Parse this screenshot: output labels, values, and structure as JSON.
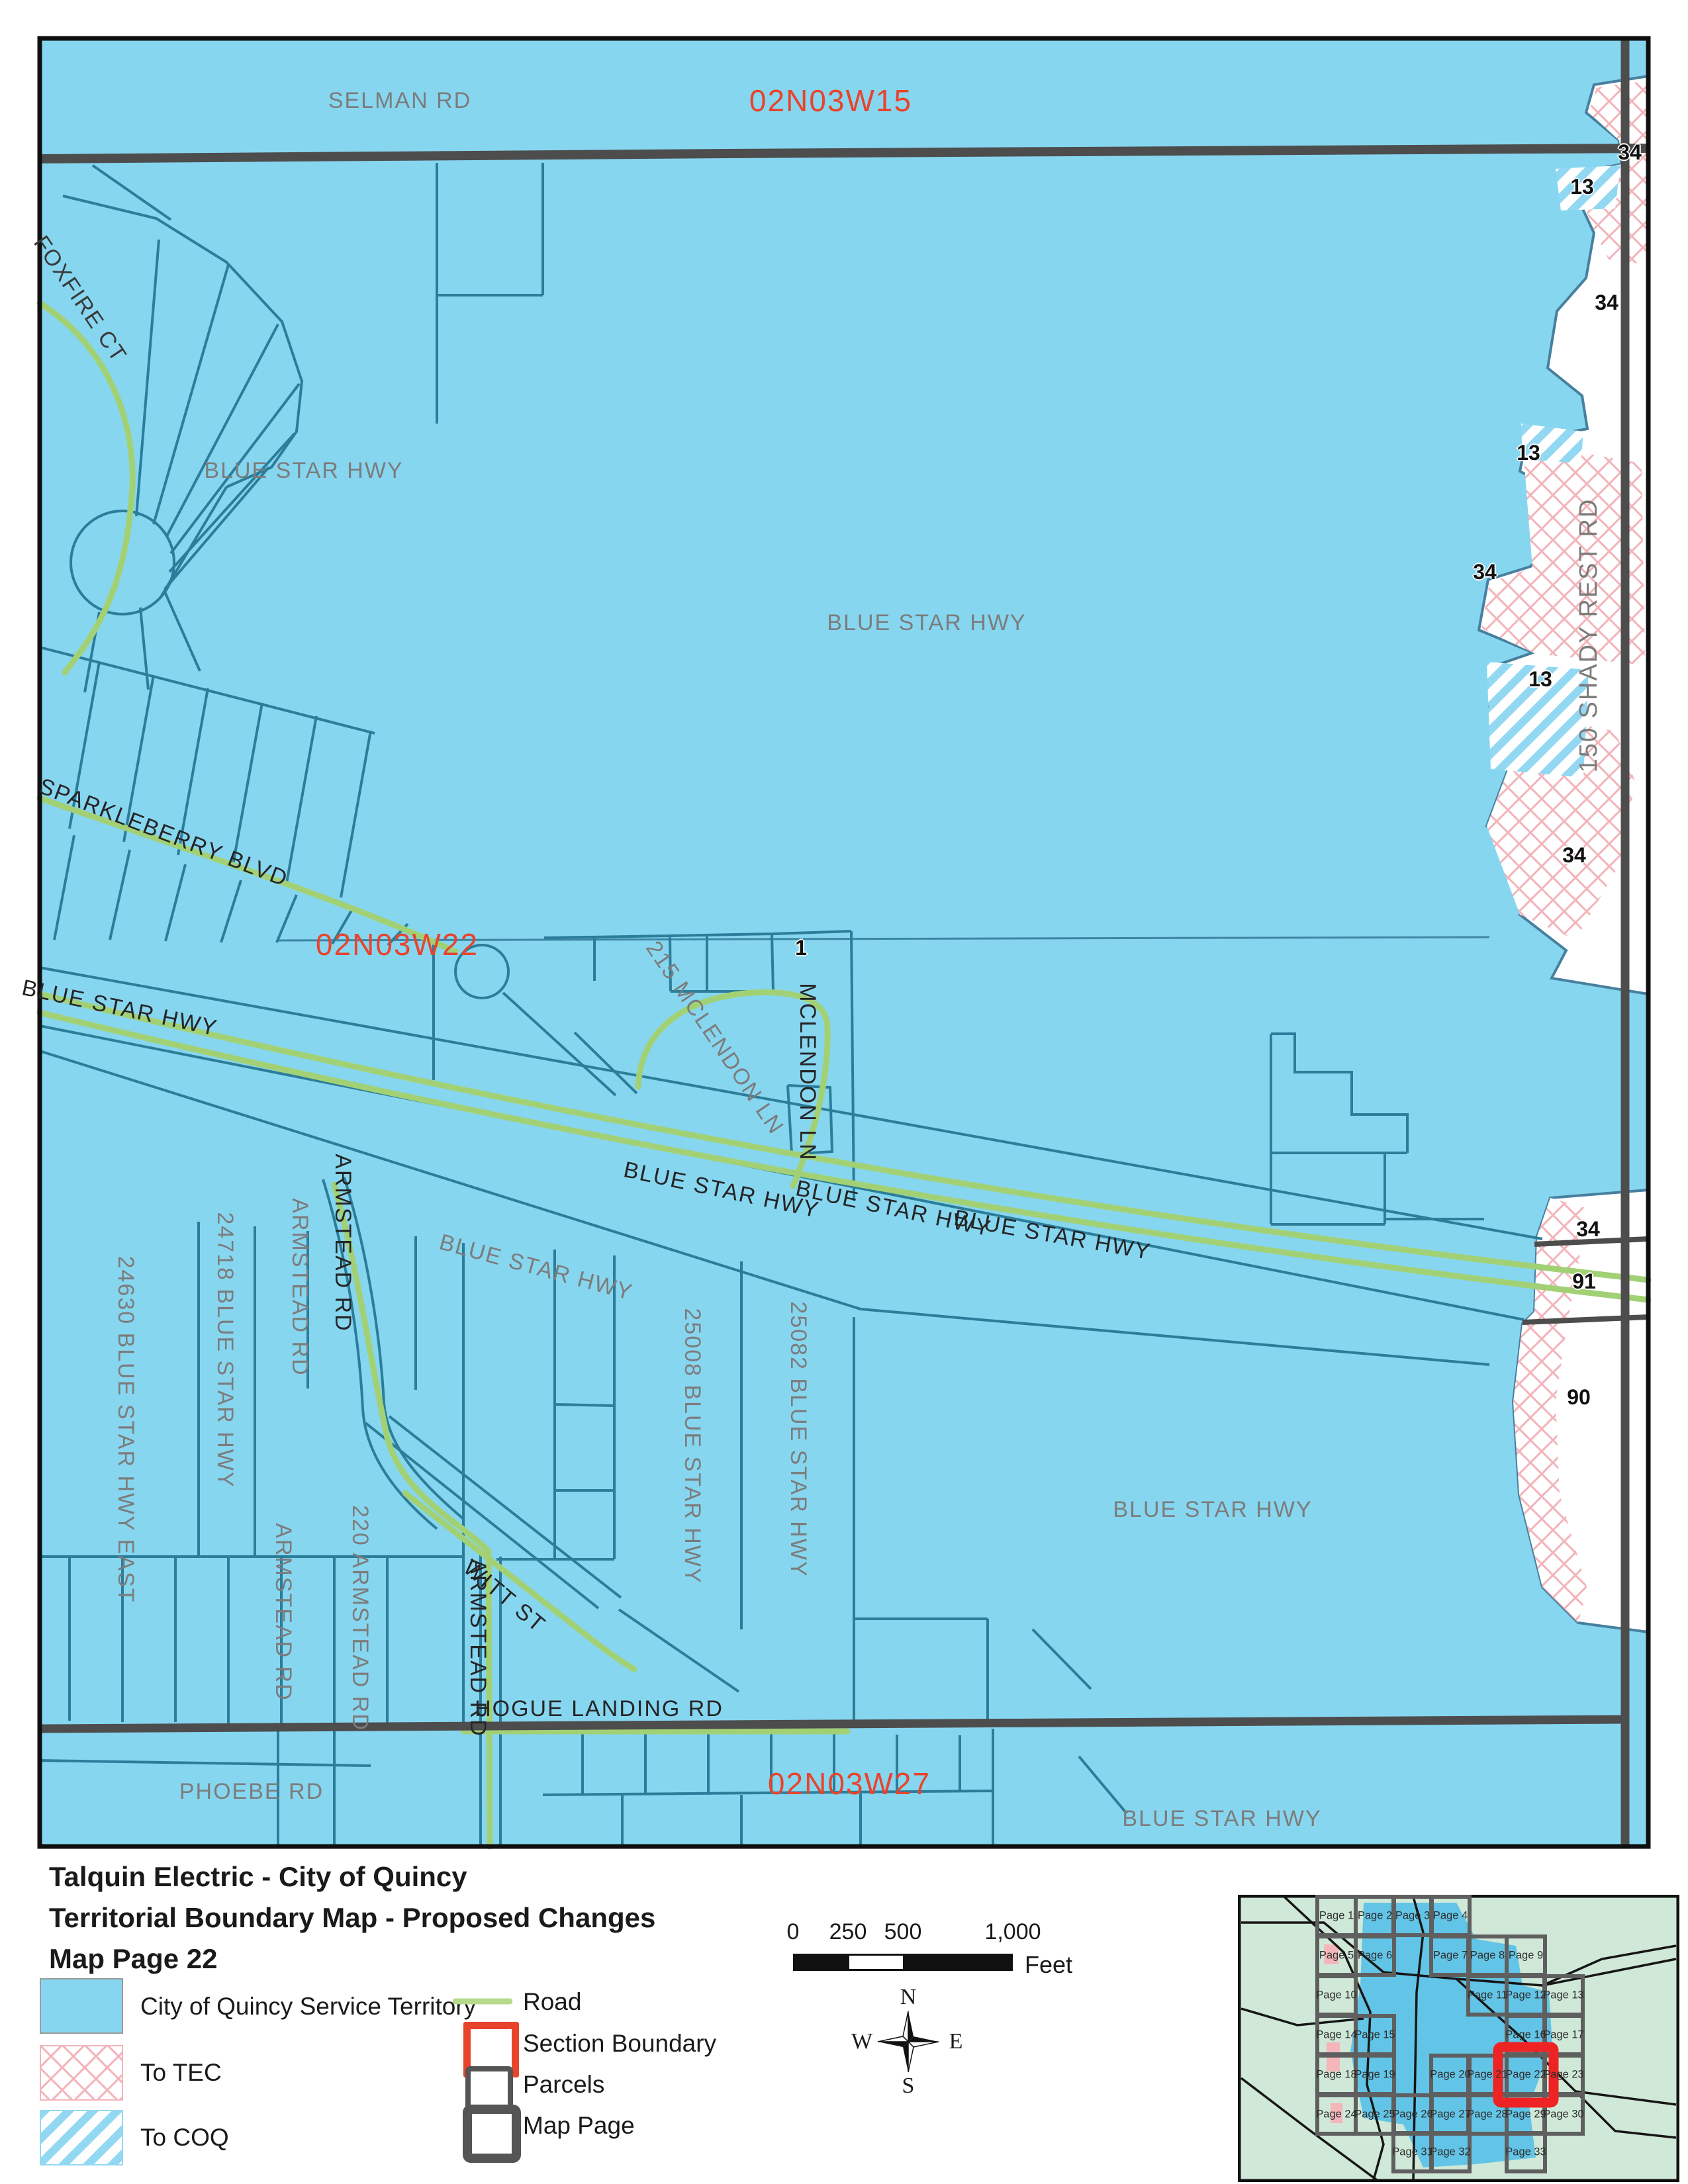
{
  "map": {
    "labels": {
      "selman_rd": "SELMAN RD",
      "section_15": "02N03W15",
      "section_22": "02N03W22",
      "section_27": "02N03W27",
      "foxfire_ct": "FOXFIRE CT",
      "blue_star_hwy": "BLUE STAR HWY",
      "sparkleberry_blvd": "SPARKLEBERRY BLVD",
      "mclendon_215": "215 MCLENDON LN",
      "mclendon_ln": "MCLENDON LN",
      "shady_rest": "150 SHADY REST RD",
      "armstead_rd": "ARMSTEAD RD",
      "armstead_220": "220 ARMSTEAD RD",
      "addr_24630": "24630 BLUE STAR HWY EAST",
      "addr_24718": "24718 BLUE STAR HWY",
      "addr_25008": "25008 BLUE STAR HWY",
      "addr_25082": "25082 BLUE STAR HWY",
      "witt_st": "WITT ST",
      "hogue_landing_rd": "HOGUE LANDING RD",
      "phoebe_rd": "PHOEBE RD"
    },
    "numbers": {
      "n34": "34",
      "n13": "13",
      "n91": "91",
      "n90": "90",
      "n1": "1"
    },
    "colors": {
      "territory_blue": "#87d6f0",
      "parcel_teal": "#2b7d9a",
      "road_gray": "#4d4d4d",
      "road_green": "#a2d175",
      "section_red": "#e8442c",
      "tec_pink": "#f2b4ba",
      "coq_blue": "#92d8f2"
    }
  },
  "legend": {
    "title_line1": "Talquin Electric - City of Quincy",
    "title_line2": "Territorial Boundary Map - Proposed Changes",
    "title_line3": "Map Page 22",
    "items": {
      "territory": "City of Quincy Service Territory",
      "tec": "To TEC",
      "coq": "To COQ",
      "road": "Road",
      "section_boundary": "Section Boundary",
      "parcels": "Parcels",
      "map_page": "Map Page"
    }
  },
  "scalebar": {
    "ticks": [
      "0",
      "250",
      "500",
      "1,000"
    ],
    "unit": "Feet"
  },
  "compass": {
    "n": "N",
    "w": "W",
    "e": "E",
    "s": "S"
  },
  "inset": {
    "highlighted_page": "Page 22",
    "pages": [
      "Page 1",
      "Page 2",
      "Page 3",
      "Page 4",
      "Page 5",
      "Page 6",
      "Page 7",
      "Page 8",
      "Page 9",
      "Page 10",
      "Page 11",
      "Page 12",
      "Page 13",
      "Page 14",
      "Page 15",
      "Page 16",
      "Page 17",
      "Page 18",
      "Page 19",
      "Page 20",
      "Page 21",
      "Page 22",
      "Page 23",
      "Page 24",
      "Page 25",
      "Page 26",
      "Page 27",
      "Page 28",
      "Page 29",
      "Page 30",
      "Page 31",
      "Page 32",
      "Page 33"
    ]
  }
}
